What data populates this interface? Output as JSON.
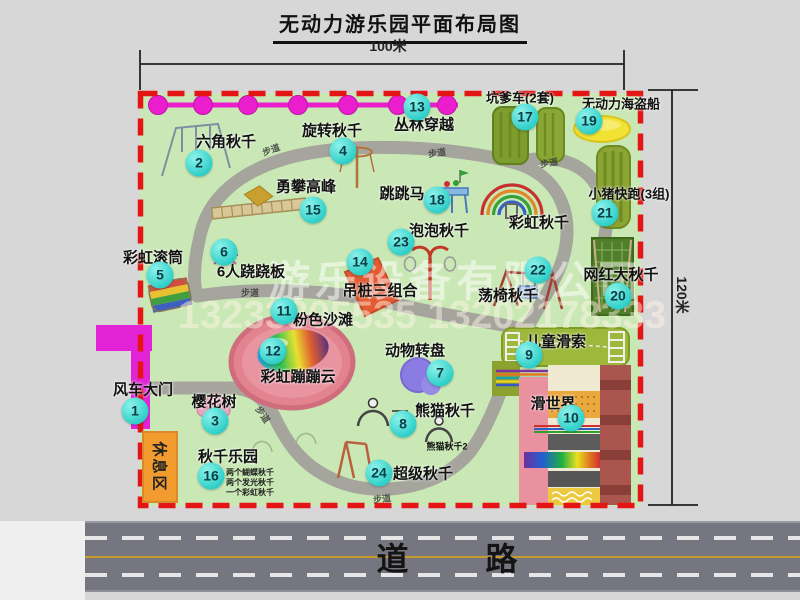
{
  "title": "无动力游乐园平面布局图",
  "dimensions": {
    "top": "100米",
    "right": "120米"
  },
  "watermark": {
    "line1": "游乐设备有限公司",
    "line2": "13233805535 13202178333"
  },
  "bottom_road": {
    "label": "道 路"
  },
  "map": {
    "path_label": "步道",
    "rest_area_label": "休息区",
    "rainbow_swing_label": "彩虹秋千",
    "panda_swing2_label": "熊猫秋千2",
    "swing_park_notes": [
      "两个蝴蝶秋千",
      "两个发光秋千",
      "一个彩虹秋千"
    ],
    "attractions": [
      {
        "num": "1",
        "name": "风车大门"
      },
      {
        "num": "2",
        "name": "六角秋千"
      },
      {
        "num": "3",
        "name": "樱花树"
      },
      {
        "num": "4",
        "name": "旋转秋千"
      },
      {
        "num": "5",
        "name": "彩虹滚筒"
      },
      {
        "num": "6",
        "name": "6人跷跷板"
      },
      {
        "num": "7",
        "name": "动物转盘"
      },
      {
        "num": "8",
        "name": "熊猫秋千"
      },
      {
        "num": "9",
        "name": "儿童滑索"
      },
      {
        "num": "10",
        "name": "滑世界"
      },
      {
        "num": "11",
        "name": "粉色沙滩"
      },
      {
        "num": "12",
        "name": "彩虹蹦蹦云"
      },
      {
        "num": "13",
        "name": "丛林穿越"
      },
      {
        "num": "14",
        "name": "吊桩三组合"
      },
      {
        "num": "15",
        "name": "勇攀高峰"
      },
      {
        "num": "16",
        "name": "秋千乐园"
      },
      {
        "num": "17",
        "name": "坑爹车(2套)"
      },
      {
        "num": "18",
        "name": "跳跳马"
      },
      {
        "num": "19",
        "name": "无动力海盗船"
      },
      {
        "num": "20",
        "name": "网红大秋千"
      },
      {
        "num": "21",
        "name": "小猪快跑(3组)"
      },
      {
        "num": "22",
        "name": "荡椅秋千"
      },
      {
        "num": "23",
        "name": "泡泡秋千"
      },
      {
        "num": "24",
        "name": "超级秋千"
      }
    ]
  },
  "colors": {
    "map_bg": "#cae8b5",
    "border_red": "#e31515",
    "badge_cyan": "#2fd0c9",
    "gate_magenta": "#e223d6",
    "chain_magenta": "#ea1ecd",
    "rest_orange": "#f29b2e",
    "road_gray": "#75767f",
    "lane_yellow": "#c79b2b"
  }
}
